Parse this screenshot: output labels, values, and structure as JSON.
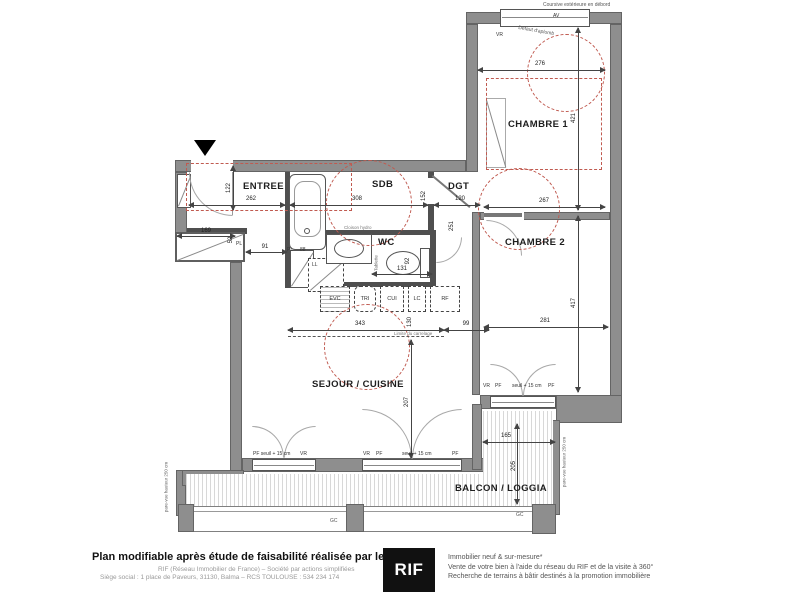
{
  "plan": {
    "rooms": {
      "entree": "ENTREE",
      "sdb": "SDB",
      "dgt": "DGT",
      "wc": "WC",
      "chambre1": "CHAMBRE 1",
      "chambre2": "CHAMBRE 2",
      "sejour": "SEJOUR / CUISINE",
      "balcon": "BALCON / LOGGIA"
    },
    "dims": {
      "d276": "276",
      "d421": "421",
      "d262": "262",
      "d122": "122",
      "d169": "169",
      "d52": "52",
      "d91": "91",
      "d88": "88",
      "d308": "308",
      "d152": "152",
      "d120": "120",
      "d251": "251",
      "d267": "267",
      "d417": "417",
      "d281": "281",
      "d131": "131",
      "d92": "92",
      "d343": "343",
      "d130": "130",
      "d99": "99",
      "d207": "207",
      "d165": "165",
      "d205": "205"
    },
    "fixtures": {
      "av": "AV",
      "vr": "VR",
      "pf": "PF",
      "ll": "LL",
      "pl": "PL",
      "evc": "EVC",
      "tri": "TRI",
      "cui": "CUI",
      "lc": "LC",
      "rf": "RF",
      "gc": "GC",
      "tablette": "Tablette"
    },
    "notes": {
      "coursive": "Coursive extérieure en débord",
      "defaut": "Défaut d'aplomb",
      "cloison": "Cloison hydro",
      "limite": "Limite du carrelage",
      "parevue": "pare-vue hauteur 250 cm",
      "pf_seuil": "PF seuil + 15 cm",
      "seuil": "seuil + 15 cm"
    }
  },
  "footer": {
    "title": "Plan modifiable après étude de faisabilité réalisée par le RIF",
    "line1": "RIF (Réseau Immobilier de France) – Société par actions simplifiées",
    "line2": "Siège social : 1 place de Paveurs, 31130, Balma – RCS TOULOUSE : 534 234 174",
    "logo": "RIF",
    "right1": "Immobilier neuf & sur-mesure*",
    "right2": "Vente de votre bien à l'aide du réseau du RIF et de la visite à 360°",
    "right3": "Recherche de terrains à bâtir destinés à la promotion immobilière"
  }
}
